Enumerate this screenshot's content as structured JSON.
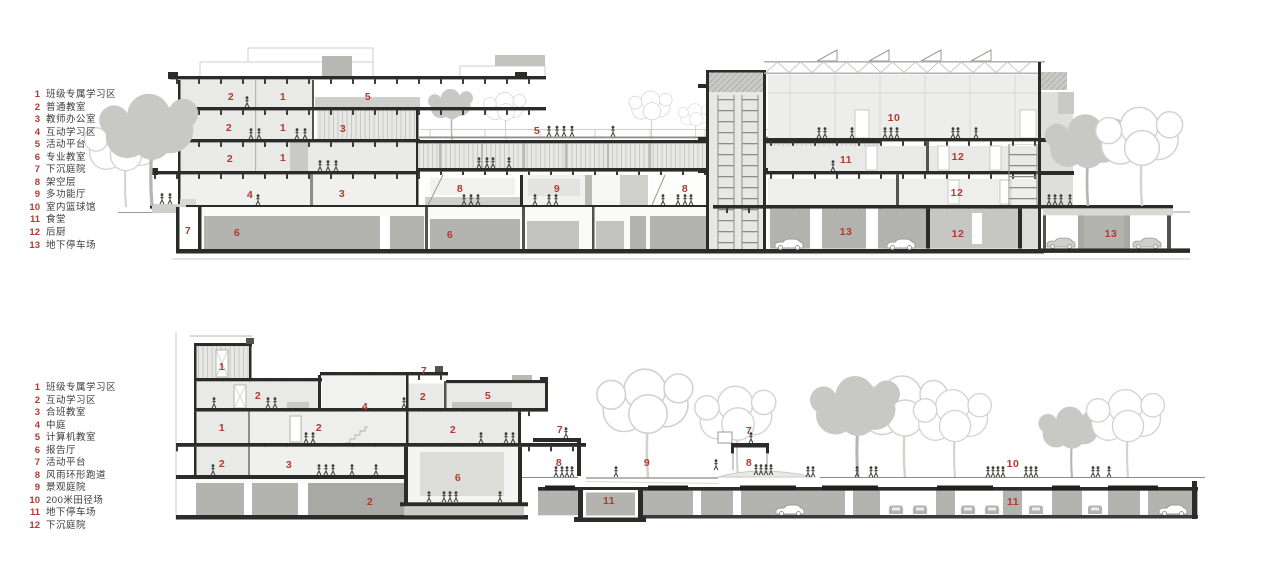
{
  "palette": {
    "label_red": "#b23a31",
    "ink": "#3b3b3b",
    "slab_dark": "#2b2b28",
    "room_fill": "#e9e9e7",
    "mass_gray": "#b3b3af",
    "tree_gray": "#c8c8c4"
  },
  "sections": {
    "top": {
      "legend": [
        {
          "n": "1",
          "label": "班级专属学习区"
        },
        {
          "n": "2",
          "label": "普通教室"
        },
        {
          "n": "3",
          "label": "教师办公室"
        },
        {
          "n": "4",
          "label": "互动学习区"
        },
        {
          "n": "5",
          "label": "活动平台"
        },
        {
          "n": "6",
          "label": "专业教室"
        },
        {
          "n": "7",
          "label": "下沉庭院"
        },
        {
          "n": "8",
          "label": "架空层"
        },
        {
          "n": "9",
          "label": "多功能厅"
        },
        {
          "n": "10",
          "label": "室内篮球馆"
        },
        {
          "n": "11",
          "label": "食堂"
        },
        {
          "n": "12",
          "label": "后厨"
        },
        {
          "n": "13",
          "label": "地下停车场"
        }
      ],
      "annotations": [
        {
          "n": "2",
          "x": 231,
          "y": 97
        },
        {
          "n": "1",
          "x": 283,
          "y": 97
        },
        {
          "n": "5",
          "x": 368,
          "y": 97
        },
        {
          "n": "2",
          "x": 229,
          "y": 128
        },
        {
          "n": "1",
          "x": 283,
          "y": 128
        },
        {
          "n": "3",
          "x": 343,
          "y": 129
        },
        {
          "n": "10",
          "x": 894,
          "y": 118
        },
        {
          "n": "5",
          "x": 537,
          "y": 131
        },
        {
          "n": "2",
          "x": 230,
          "y": 159
        },
        {
          "n": "1",
          "x": 283,
          "y": 158
        },
        {
          "n": "11",
          "x": 846,
          "y": 160
        },
        {
          "n": "12",
          "x": 958,
          "y": 157
        },
        {
          "n": "4",
          "x": 250,
          "y": 195
        },
        {
          "n": "3",
          "x": 342,
          "y": 194
        },
        {
          "n": "8",
          "x": 460,
          "y": 189
        },
        {
          "n": "9",
          "x": 557,
          "y": 189
        },
        {
          "n": "8",
          "x": 685,
          "y": 189
        },
        {
          "n": "12",
          "x": 957,
          "y": 193
        },
        {
          "n": "7",
          "x": 188,
          "y": 231
        },
        {
          "n": "6",
          "x": 237,
          "y": 233
        },
        {
          "n": "6",
          "x": 450,
          "y": 235
        },
        {
          "n": "13",
          "x": 846,
          "y": 232
        },
        {
          "n": "12",
          "x": 958,
          "y": 234
        },
        {
          "n": "13",
          "x": 1111,
          "y": 234
        }
      ]
    },
    "bottom": {
      "legend": [
        {
          "n": "1",
          "label": "班级专属学习区"
        },
        {
          "n": "2",
          "label": "互动学习区"
        },
        {
          "n": "3",
          "label": "合班教室"
        },
        {
          "n": "4",
          "label": "中庭"
        },
        {
          "n": "5",
          "label": "计算机教室"
        },
        {
          "n": "6",
          "label": "报告厅"
        },
        {
          "n": "7",
          "label": "活动平台"
        },
        {
          "n": "8",
          "label": "风雨环形跑道"
        },
        {
          "n": "9",
          "label": "景观庭院"
        },
        {
          "n": "10",
          "label": "200米田径场"
        },
        {
          "n": "11",
          "label": "地下停车场"
        },
        {
          "n": "12",
          "label": "下沉庭院"
        }
      ],
      "annotations": [
        {
          "n": "1",
          "x": 222,
          "y": 367
        },
        {
          "n": "7",
          "x": 424,
          "y": 371
        },
        {
          "n": "2",
          "x": 258,
          "y": 396
        },
        {
          "n": "2",
          "x": 423,
          "y": 397
        },
        {
          "n": "5",
          "x": 488,
          "y": 396
        },
        {
          "n": "4",
          "x": 365,
          "y": 407
        },
        {
          "n": "1",
          "x": 222,
          "y": 428
        },
        {
          "n": "2",
          "x": 319,
          "y": 428
        },
        {
          "n": "2",
          "x": 453,
          "y": 430
        },
        {
          "n": "7",
          "x": 560,
          "y": 430
        },
        {
          "n": "7",
          "x": 749,
          "y": 431
        },
        {
          "n": "2",
          "x": 222,
          "y": 464
        },
        {
          "n": "3",
          "x": 289,
          "y": 465
        },
        {
          "n": "8",
          "x": 559,
          "y": 463
        },
        {
          "n": "9",
          "x": 647,
          "y": 463
        },
        {
          "n": "8",
          "x": 749,
          "y": 463
        },
        {
          "n": "10",
          "x": 1013,
          "y": 464
        },
        {
          "n": "6",
          "x": 458,
          "y": 478
        },
        {
          "n": "2",
          "x": 370,
          "y": 502
        },
        {
          "n": "11",
          "x": 609,
          "y": 501
        },
        {
          "n": "11",
          "x": 1013,
          "y": 502
        }
      ]
    }
  }
}
